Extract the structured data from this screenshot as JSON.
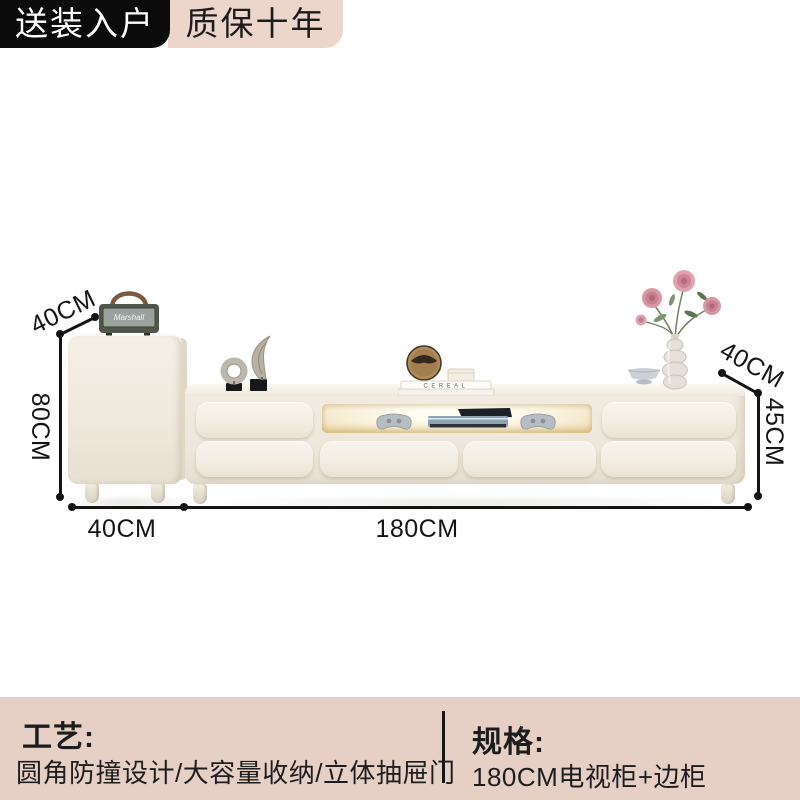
{
  "badges": {
    "delivery": "送装入户",
    "warranty": "质保十年"
  },
  "dimensions": {
    "side_depth": "40CM",
    "side_height": "80CM",
    "side_width": "40CM",
    "tv_width": "180CM",
    "tv_depth": "40CM",
    "tv_height": "45CM"
  },
  "decor": {
    "speaker_brand": "Marshall",
    "book_spine": "CEREAL"
  },
  "info": {
    "craft_label": "工艺:",
    "craft_value": "圆角防撞设计/大容量收纳/立体抽屉门",
    "spec_label": "规格:",
    "spec_value": "180CM电视柜+边柜"
  },
  "colors": {
    "badge_bg": "#0b0b0b",
    "badge_text": "#ffffff",
    "accent_pink": "#ecd5cb",
    "panel_pink": "#e6d0c5",
    "furniture_cream": "#f1ebe1",
    "dimension_line": "#141414"
  }
}
